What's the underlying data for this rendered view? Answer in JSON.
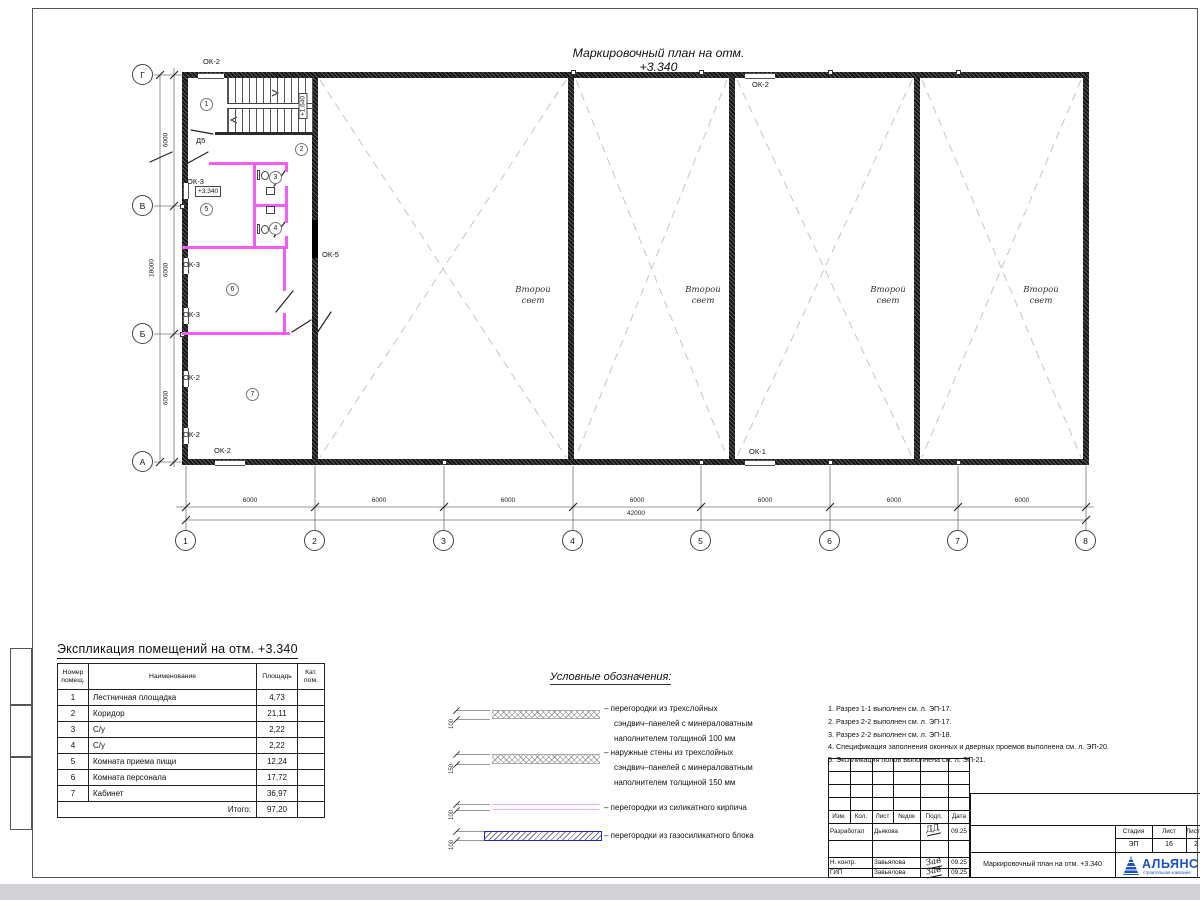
{
  "sheet": {
    "plan_title": "Маркировочный план на отм. +3.340"
  },
  "plan": {
    "grid_cols": [
      "1",
      "2",
      "3",
      "4",
      "5",
      "6",
      "7",
      "8"
    ],
    "grid_rows": [
      "Г",
      "В",
      "Б",
      "А"
    ],
    "dim_col": [
      "6000",
      "6000",
      "6000",
      "6000",
      "6000",
      "6000",
      "6000"
    ],
    "dim_col_total": "42000",
    "dim_row": [
      "6000",
      "6000",
      "6000"
    ],
    "dim_row_total": "18000",
    "room_numbers": [
      "1",
      "2",
      "3",
      "4",
      "5",
      "6",
      "7"
    ],
    "wall_labels": [
      "ОК-2",
      "ОК-2",
      "ОК-3",
      "ОК-3",
      "ОК-3",
      "ОК-2",
      "ОК-2",
      "ОК-2",
      "ОК-1",
      "ОК-5",
      "Д5"
    ],
    "level_mark": "+3.340",
    "stair_mark": "+1.640",
    "second_light": [
      "Второй",
      "свет"
    ]
  },
  "explication": {
    "title": "Экспликация помещений на отм. +3.340",
    "headers": [
      "Номер помещ.",
      "Наименование",
      "Площадь",
      "Кат. пом."
    ],
    "rows": [
      [
        "1",
        "Лестничная площадка",
        "4,73"
      ],
      [
        "2",
        "Коридор",
        "21,11"
      ],
      [
        "3",
        "С/у",
        "2,22"
      ],
      [
        "4",
        "С/у",
        "2,22"
      ],
      [
        "5",
        "Комната приема пищи",
        "12,24"
      ],
      [
        "6",
        "Комната персонала",
        "17,72"
      ],
      [
        "7",
        "Кабинет",
        "36,97"
      ]
    ],
    "total_label": "Итого:",
    "total_value": "97,20"
  },
  "legend": {
    "title": "Условные обозначения:",
    "items": [
      {
        "thickness": "100",
        "lines": [
          "– перегородки из трехслойных",
          "сэндвич–панелей с минераловатным",
          "наполнителем толщиной 100 мм"
        ]
      },
      {
        "thickness": "150",
        "lines": [
          "– наружные стены из трехслойных",
          "сэндвич–панелей с минераловатным",
          "наполнителем толщиной 150 мм"
        ]
      },
      {
        "thickness": "100",
        "lines": [
          "– перегородки из силикатного кирпича"
        ]
      },
      {
        "thickness": "100",
        "lines": [
          "– перегородки из газосиликатного блока"
        ]
      }
    ]
  },
  "notes": [
    "1. Разрез 1-1 выполнен см. л. ЭП-17.",
    "2. Разрез 2-2 выполнен см. л. ЭП-17.",
    "3. Разрез 2-2 выполнен см. л. ЭП-18.",
    "4. Спецификация заполнения оконных и дверных проемов выполнена см. л. ЭП-20.",
    "5. Экспликация полов выполнена см. л. ЭП-21."
  ],
  "titleblock": {
    "rev_headers": [
      "Изм.",
      "Кол.",
      "Лист",
      "№док",
      "Подп.",
      "Дата"
    ],
    "rows": [
      {
        "role": "Разработал",
        "name": "Дьякова",
        "sig": "ДД",
        "date": "09.25"
      },
      {
        "role": "Н. контр.",
        "name": "Завьялова",
        "sig": "Зав",
        "date": "09.25"
      },
      {
        "role": "ГИП",
        "name": "Завьялова",
        "sig": "Зав",
        "date": "09.25"
      }
    ],
    "doc_title": "Маркировочный план на отм. +3.340",
    "stage_header": "Стадия",
    "sheet_header": "Лист",
    "sheets_header": "Листов",
    "stage": "ЭП",
    "sheet_no": "16",
    "sheets_total": "2",
    "logo": {
      "name": "АЛЬЯНС",
      "subtitle": "строительная компания"
    }
  },
  "colors": {
    "partition_magenta": "#f55cf5",
    "legend_blue": "#2026c8",
    "logo_blue": "#1a53c0"
  }
}
